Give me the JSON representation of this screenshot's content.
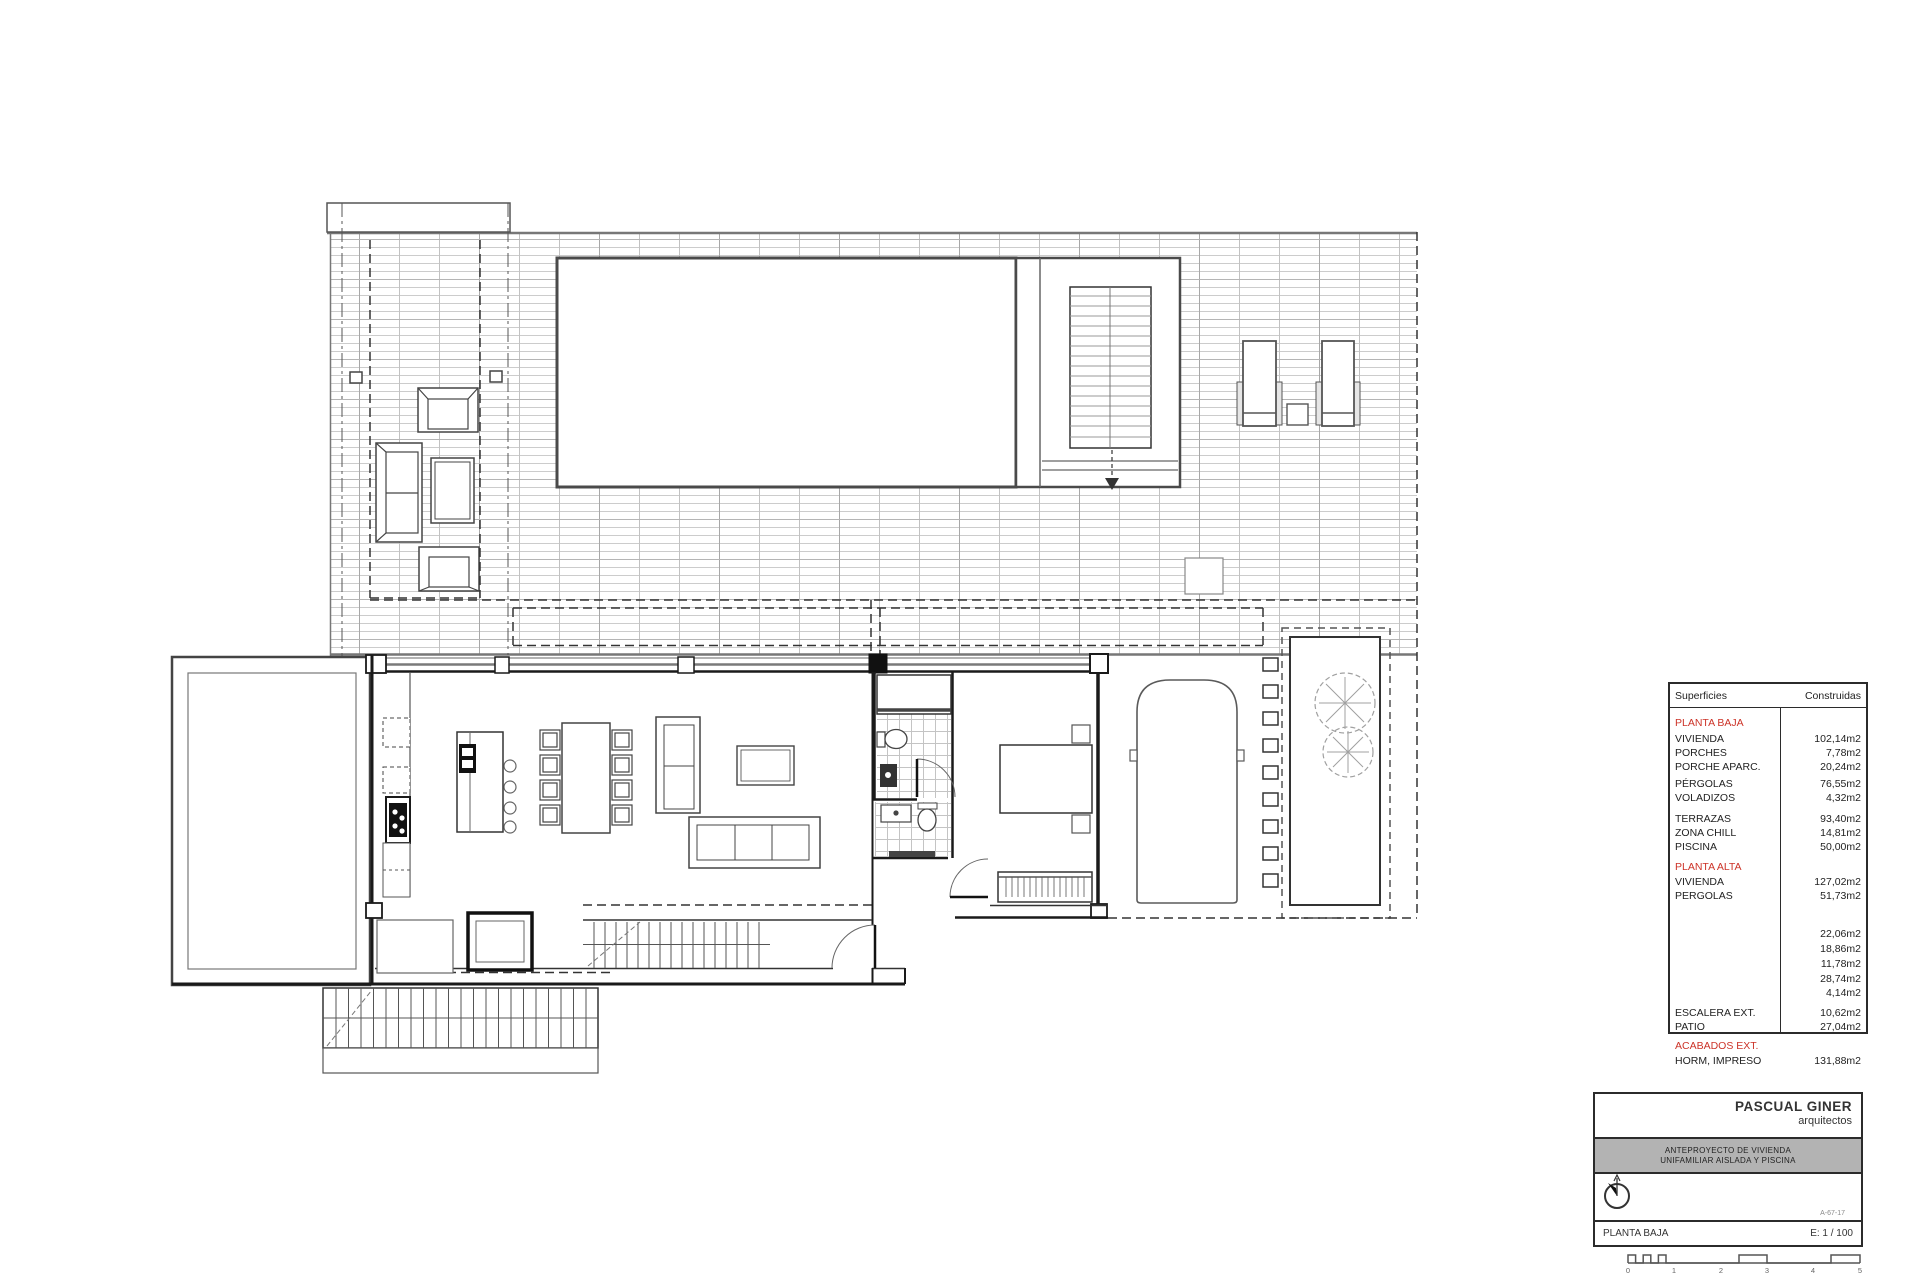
{
  "surfaces_table": {
    "header": {
      "col1": "Superficies",
      "col2": "Construidas"
    },
    "rows": [
      {
        "label": "PLANTA BAJA",
        "value": ""
      },
      {
        "label": "VIVIENDA",
        "value": "102,14m2"
      },
      {
        "label": "PORCHES",
        "value": "7,78m2"
      },
      {
        "label": "PORCHE APARC.",
        "value": "20,24m2"
      },
      {
        "label": "PÉRGOLAS",
        "value": "76,55m2"
      },
      {
        "label": "VOLADIZOS",
        "value": "4,32m2"
      },
      {
        "label": "TERRAZAS",
        "value": "93,40m2"
      },
      {
        "label": "ZONA CHILL",
        "value": "14,81m2"
      },
      {
        "label": "PISCINA",
        "value": "50,00m2"
      },
      {
        "label": "PLANTA ALTA",
        "value": ""
      },
      {
        "label": "VIVIENDA",
        "value": "127,02m2"
      },
      {
        "label": "PERGOLAS",
        "value": "51,73m2"
      },
      {
        "label": "",
        "value": "22,06m2"
      },
      {
        "label": "",
        "value": "18,86m2"
      },
      {
        "label": "",
        "value": "11,78m2"
      },
      {
        "label": "",
        "value": "28,74m2"
      },
      {
        "label": "",
        "value": "4,14m2"
      },
      {
        "label": "ESCALERA EXT.",
        "value": "10,62m2"
      },
      {
        "label": "PATIO",
        "value": "27,04m2"
      },
      {
        "label": "ACABADOS EXT.",
        "value": ""
      },
      {
        "label": "HORM, IMPRESO",
        "value": "131,88m2"
      }
    ]
  },
  "title_block": {
    "firm_name": "PASCUAL GINER",
    "firm_subtitle": "arquitectos",
    "project_title_line1": "ANTEPROYECTO DE VIVIENDA",
    "project_title_line2": "UNIFAMILIAR AISLADA Y PISCINA",
    "drawing_name": "PLANTA BAJA",
    "scale": "E: 1 / 100",
    "sheet_ref": "A-67-17"
  },
  "scale_bar": {
    "labels": [
      "0",
      "1",
      "2",
      "3",
      "4",
      "5"
    ]
  },
  "colors": {
    "accent_red": "#cc3328",
    "line_dark": "#1a1a1a",
    "line_mid": "#555555",
    "grid_light": "#c6c6c6",
    "gray_band": "#b3b3b3"
  }
}
